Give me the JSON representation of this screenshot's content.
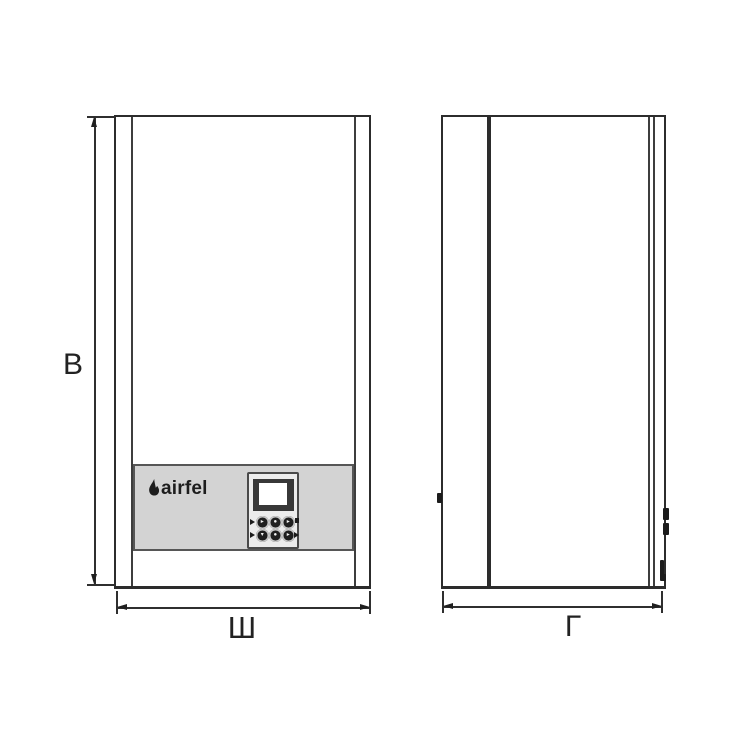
{
  "drawing": {
    "subject": "wall-hung boiler two-view dimension drawing",
    "colors": {
      "line": "#2c2c2c",
      "panel_gray": "#d3d3d3",
      "background": "#ffffff"
    }
  },
  "dimensions": {
    "height": {
      "label": "В"
    },
    "width": {
      "label": "Ш"
    },
    "depth": {
      "label": "Г"
    }
  },
  "logo": {
    "text": "airfel",
    "icon": "flame-icon"
  },
  "display": {
    "buttons": [
      "▸",
      "●",
      "▸",
      "▾",
      "●",
      "▸"
    ]
  }
}
